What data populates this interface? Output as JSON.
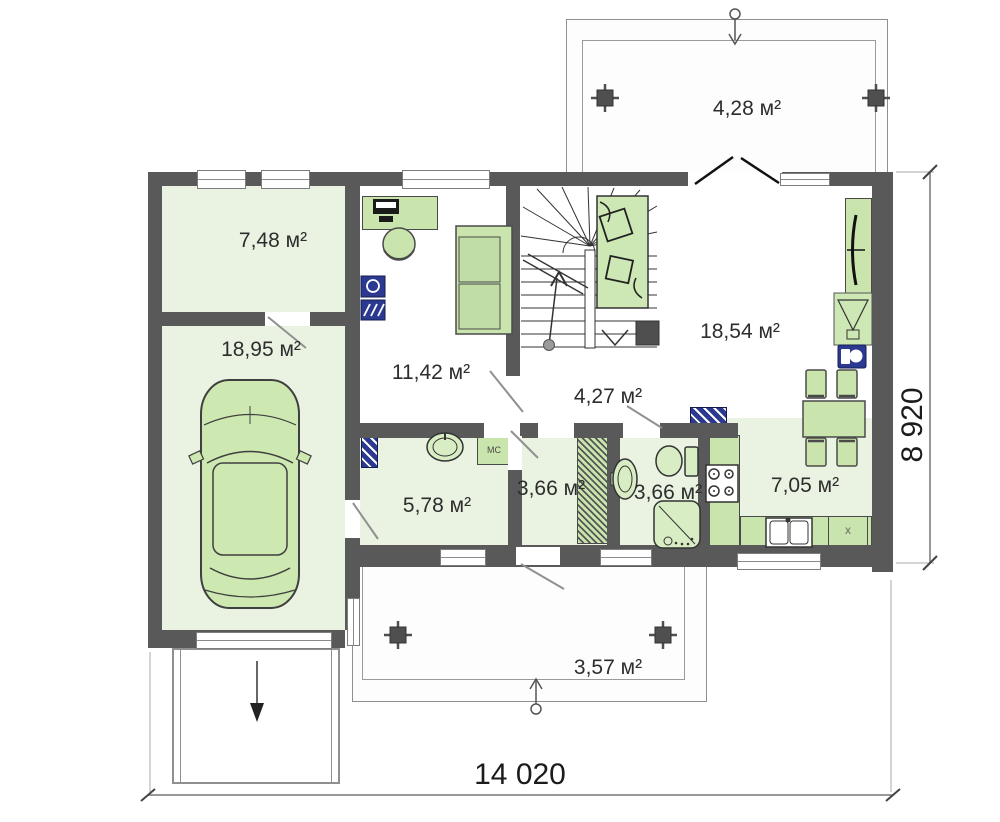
{
  "plan": {
    "rooms": [
      {
        "id": "terrace-top",
        "area_label": "4,28 м²"
      },
      {
        "id": "cabinet-room",
        "area_label": "7,48 м²"
      },
      {
        "id": "garage",
        "area_label": "18,95 м²"
      },
      {
        "id": "hall",
        "area_label": "11,42 м²"
      },
      {
        "id": "living-room",
        "area_label": "18,54 м²"
      },
      {
        "id": "corridor",
        "area_label": "4,27 м²"
      },
      {
        "id": "utility-room",
        "area_label": "5,78 м²"
      },
      {
        "id": "wardrobe-room",
        "area_label": "3,66 м²"
      },
      {
        "id": "bathroom",
        "area_label": "3,66 м²"
      },
      {
        "id": "kitchen",
        "area_label": "7,05 м²"
      },
      {
        "id": "terrace-bottom",
        "area_label": "3,57 м²"
      }
    ],
    "furniture_labels": {
      "washing_machine": "МС",
      "cabinet_x": "x"
    },
    "dimensions": {
      "width_label": "14 020",
      "height_label": "8 920"
    },
    "icons": [
      "car-icon",
      "stairs-icon",
      "sofa-icon",
      "daybed-icon",
      "desk-computer-icon",
      "round-chair-icon",
      "toilet-icon",
      "washbasin-icon",
      "shower-icon",
      "stove-icon",
      "kitchen-sink-icon",
      "dining-set-icon",
      "tv-icon",
      "fireplace-icon",
      "boiler-icon",
      "radiator-icon",
      "wardrobe-icon",
      "entry-arrow-icon"
    ],
    "colors": {
      "wall": "#595959",
      "room_fill": "#eaf3e2",
      "furniture_fill": "#c9e4ad",
      "accent_navy": "#2b3990"
    }
  }
}
